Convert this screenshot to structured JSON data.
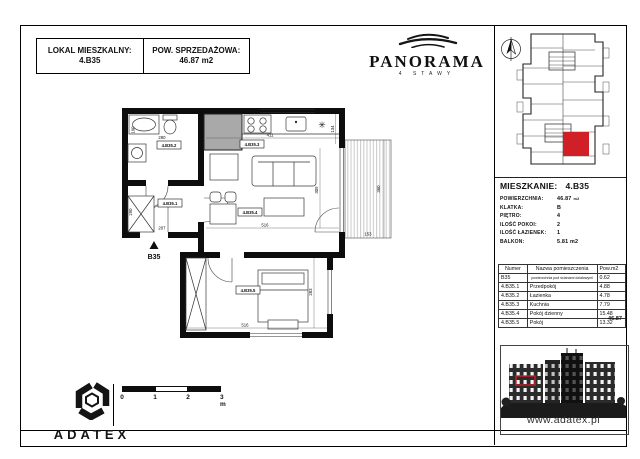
{
  "header": {
    "unit_box": {
      "label": "LOKAL MIESZKALNY:",
      "value": "4.B35"
    },
    "area_box": {
      "label": "POW. SPRZEDAŻOWA:",
      "value": "46.87 m2"
    }
  },
  "brand": {
    "name": "PANORAMA",
    "subtitle": "4 STAWY"
  },
  "apartment_info": {
    "title_label": "MIESZKANIE:",
    "title_value": "4.B35",
    "rows": [
      {
        "label": "POWIERZCHNIA:",
        "value": "46.87",
        "unit": "m2"
      },
      {
        "label": "KLATKA:",
        "value": "B",
        "unit": ""
      },
      {
        "label": "PIĘTRO:",
        "value": "4",
        "unit": ""
      },
      {
        "label": "ILOŚĆ POKOI:",
        "value": "2",
        "unit": ""
      },
      {
        "label": "ILOŚĆ ŁAZIENEK:",
        "value": "1",
        "unit": ""
      },
      {
        "label": "BALKON:",
        "value": "5.81 m2",
        "unit": ""
      }
    ]
  },
  "room_table": {
    "headers": [
      "Numer",
      "Nazwa pomieszczenia",
      "Pow.m2"
    ],
    "partition_row": {
      "numer": "B35",
      "name": "powierzchnia pod ścianami działowymi",
      "area": "0.62"
    },
    "rows": [
      {
        "numer": "4.B35.1",
        "name": "Przedpokój",
        "area": "4.88"
      },
      {
        "numer": "4.B35.2",
        "name": "Łazienka",
        "area": "4.78"
      },
      {
        "numer": "4.B35.3",
        "name": "Kuchnia",
        "area": "7.79"
      },
      {
        "numer": "4.B35.4",
        "name": "Pokój dzienny",
        "area": "15.48"
      },
      {
        "numer": "4.B35.5",
        "name": "Pokój",
        "area": "13.32"
      }
    ],
    "total": "46.87"
  },
  "plan": {
    "room_labels": [
      {
        "room": "bathroom",
        "text": "4.B35.2"
      },
      {
        "room": "kitchen",
        "text": "4.B35.3"
      },
      {
        "room": "hall",
        "text": "4.B35.1"
      },
      {
        "room": "living",
        "text": "4.B35.4"
      },
      {
        "room": "bedroom",
        "text": "4.B35.5"
      }
    ],
    "dimensions": {
      "bath_width": "290",
      "left_top": "190",
      "left_mid": "290",
      "kitchen_width": "411",
      "right_top": "134",
      "living_height": "309",
      "living_width": "516",
      "balcony_height": "360",
      "balcony_width": "153",
      "hall_entry": "207",
      "bedroom_width": "516",
      "bedroom_height": "283"
    },
    "entrance_label": "B35"
  },
  "footer": {
    "logo_text": "ADATEX",
    "scale_labels": [
      "0",
      "1",
      "2",
      "3 m"
    ],
    "website": "www.adatex.pl"
  },
  "colors": {
    "unit_red": "#d01f27",
    "wall": "#0d0d0d",
    "shaft_gray": "#a9a9a9"
  }
}
